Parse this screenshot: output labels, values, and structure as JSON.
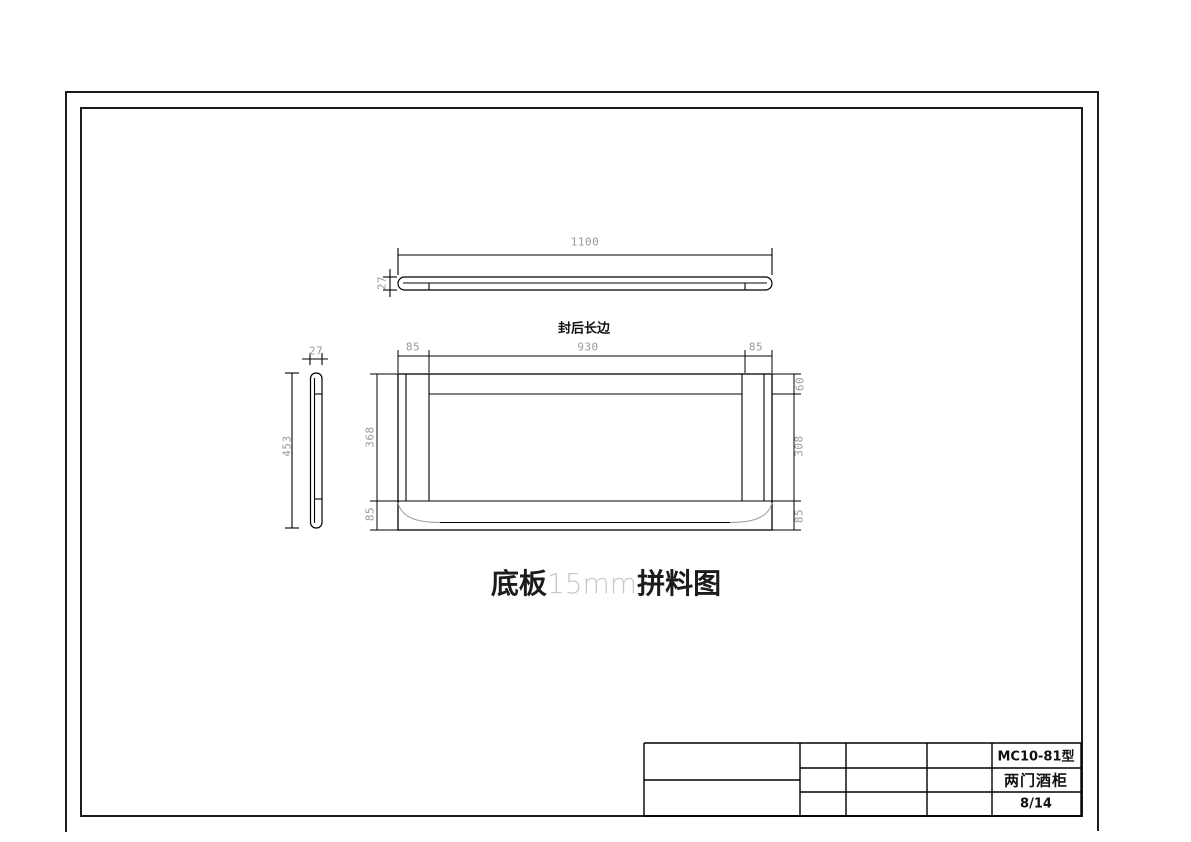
{
  "drawing": {
    "top_view": {
      "length": "1100",
      "thickness": "27"
    },
    "plan_view": {
      "edge_label": "封后长边",
      "width_left": "85",
      "width_center": "930",
      "width_right": "85",
      "height_upper_left": "368",
      "height_lower_left": "85",
      "height_top_right": "60",
      "height_middle_right": "308",
      "height_bottom_right": "85"
    },
    "side_view": {
      "thickness": "27",
      "height": "453"
    }
  },
  "caption": {
    "part": "底板",
    "size": "15mm",
    "suffix": "拼料图"
  },
  "title_block": {
    "model": "MC10-81型",
    "product": "两门酒柜",
    "sheet": "8/14"
  },
  "colors": {
    "line": "#000000",
    "dim_text": "#9a9a9a",
    "light_text": "#c7c7c7"
  }
}
